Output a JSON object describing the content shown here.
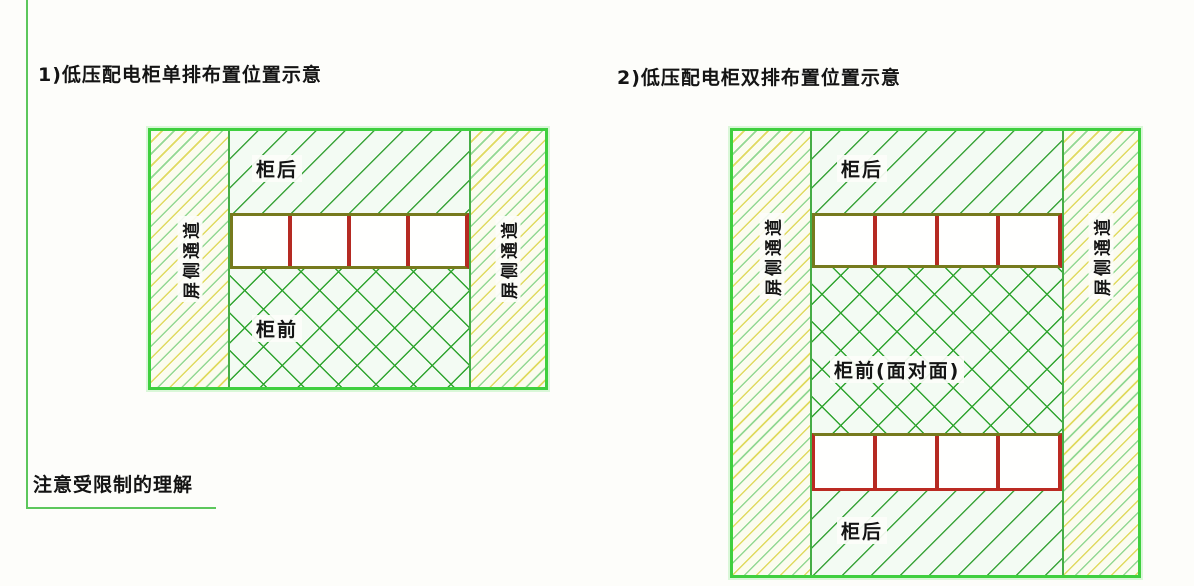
{
  "titles": {
    "diagram1": "1)低压配电柜单排布置位置示意",
    "diagram2": "2)低压配电柜双排布置位置示意"
  },
  "note": "注意受限制的理解",
  "labels": {
    "aisle": "屏侧通道",
    "cabinet_back": "柜后",
    "cabinet_front": "柜前",
    "cabinet_front_face_to_face": "柜前(面对面)"
  },
  "diagram1": {
    "rows": 1,
    "cabinets_per_row": 4
  },
  "diagram2": {
    "rows": 2,
    "cabinets_per_row": 4
  },
  "colors": {
    "outer_border_green": "#3fcf3f",
    "hatch_green": "#3ba43b",
    "hatch_yellow": "#e0da60",
    "hatch_light_green": "#93d893",
    "cabinet_divider_red": "#b52a22",
    "cabinet_frame_olive": "#767a1d",
    "guide_line_green": "#5cc75c",
    "text": "#141414"
  }
}
